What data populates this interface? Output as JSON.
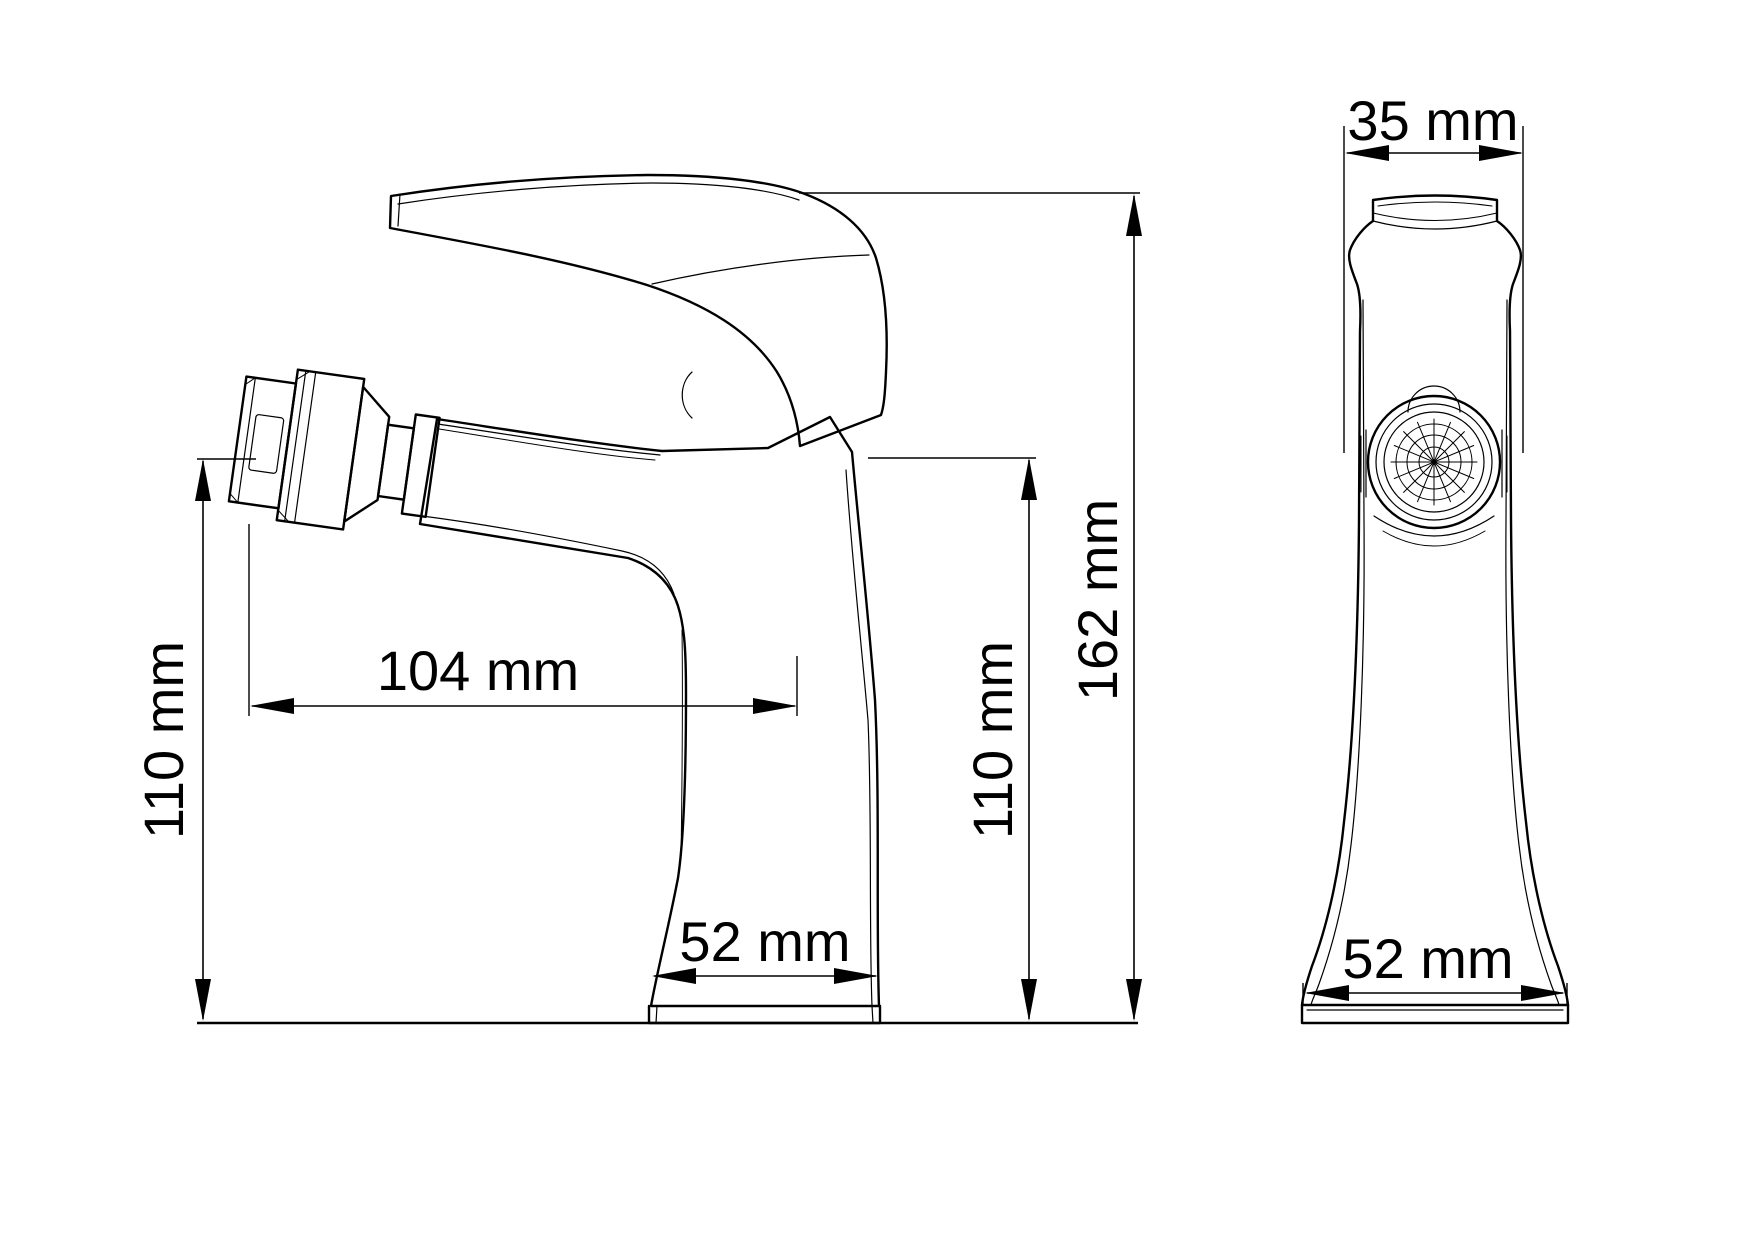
{
  "drawing": {
    "type": "technical-dimension-drawing",
    "subject": "single-lever bidet faucet, side view and front view",
    "colors": {
      "line": "#000000",
      "background": "#ffffff"
    },
    "views": {
      "side": {
        "name": "side-view"
      },
      "front": {
        "name": "front-view"
      }
    },
    "dimensions": {
      "side_spout_height": {
        "label": "110 mm",
        "orientation": "vertical"
      },
      "side_reach": {
        "label": "104 mm",
        "orientation": "horizontal"
      },
      "side_body_height": {
        "label": "110 mm",
        "orientation": "vertical"
      },
      "side_total_height": {
        "label": "162 mm",
        "orientation": "vertical"
      },
      "side_base_width": {
        "label": "52 mm",
        "orientation": "horizontal"
      },
      "front_top_width": {
        "label": "35 mm",
        "orientation": "horizontal"
      },
      "front_base_width": {
        "label": "52 mm",
        "orientation": "horizontal"
      }
    }
  }
}
